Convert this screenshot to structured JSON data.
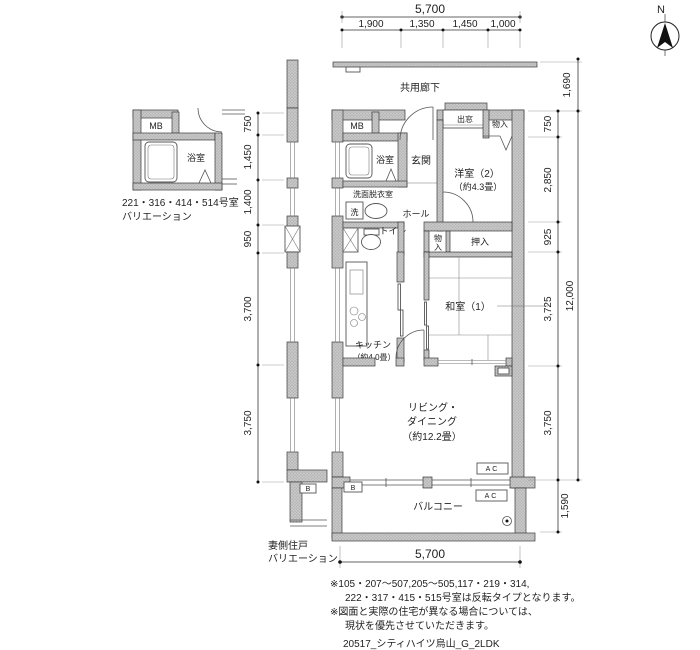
{
  "compass": {
    "north_label": "N"
  },
  "plan": {
    "corridor": "共用廊下",
    "mb": "MB",
    "bath": "浴室",
    "entrance": "玄関",
    "bay_window": "出窓",
    "closet_top": "物入",
    "western_room_name": "洋室（2）",
    "western_room_area": "（約4.3畳）",
    "washroom": "洗面脱衣室",
    "washer": "洗",
    "hall": "ホール",
    "toilet": "トイレ",
    "closet_mid_char1": "物",
    "closet_mid_char2": "入",
    "oshiire": "押入",
    "japanese_room_name": "和室（1）",
    "kitchen_name": "キッチン",
    "kitchen_area": "（約4.0畳）",
    "living_line1": "リビング・",
    "living_line2": "ダイニング",
    "living_area": "（約12.2畳）",
    "balcony": "バルコニー",
    "ac_indoor": "AC",
    "ac_balcony": "AC",
    "b_box": "B",
    "b_box_strip": "B"
  },
  "variation_small": {
    "mb": "MB",
    "bath": "浴室",
    "caption_line1": "221・316・414・514号室",
    "caption_line2": "バリエーション"
  },
  "variation_gable": {
    "caption_line1": "妻側住戸",
    "caption_line2": "バリエーション"
  },
  "dimensions": {
    "top_total": "5,700",
    "top_segments": [
      "1,900",
      "1,350",
      "1,450",
      "1,000"
    ],
    "left_segments": [
      "750",
      "1,450",
      "1,400",
      "950",
      "3,700",
      "3,750"
    ],
    "right_segments": [
      "1,690",
      "750",
      "2,850",
      "925",
      "3,725",
      "3,750",
      "1,590"
    ],
    "right_total": "12,000",
    "bottom_total": "5,700"
  },
  "notes": {
    "line1": "※105・207〜507,205〜505,117・219・314,",
    "line2": "222・317・415・515号室は反転タイプとなります。",
    "line3": "※図面と実際の住宅が異なる場合については、",
    "line4": "現状を優先させていただきます。",
    "drawing_code": "20517_シティハイツ烏山_G_2LDK"
  }
}
